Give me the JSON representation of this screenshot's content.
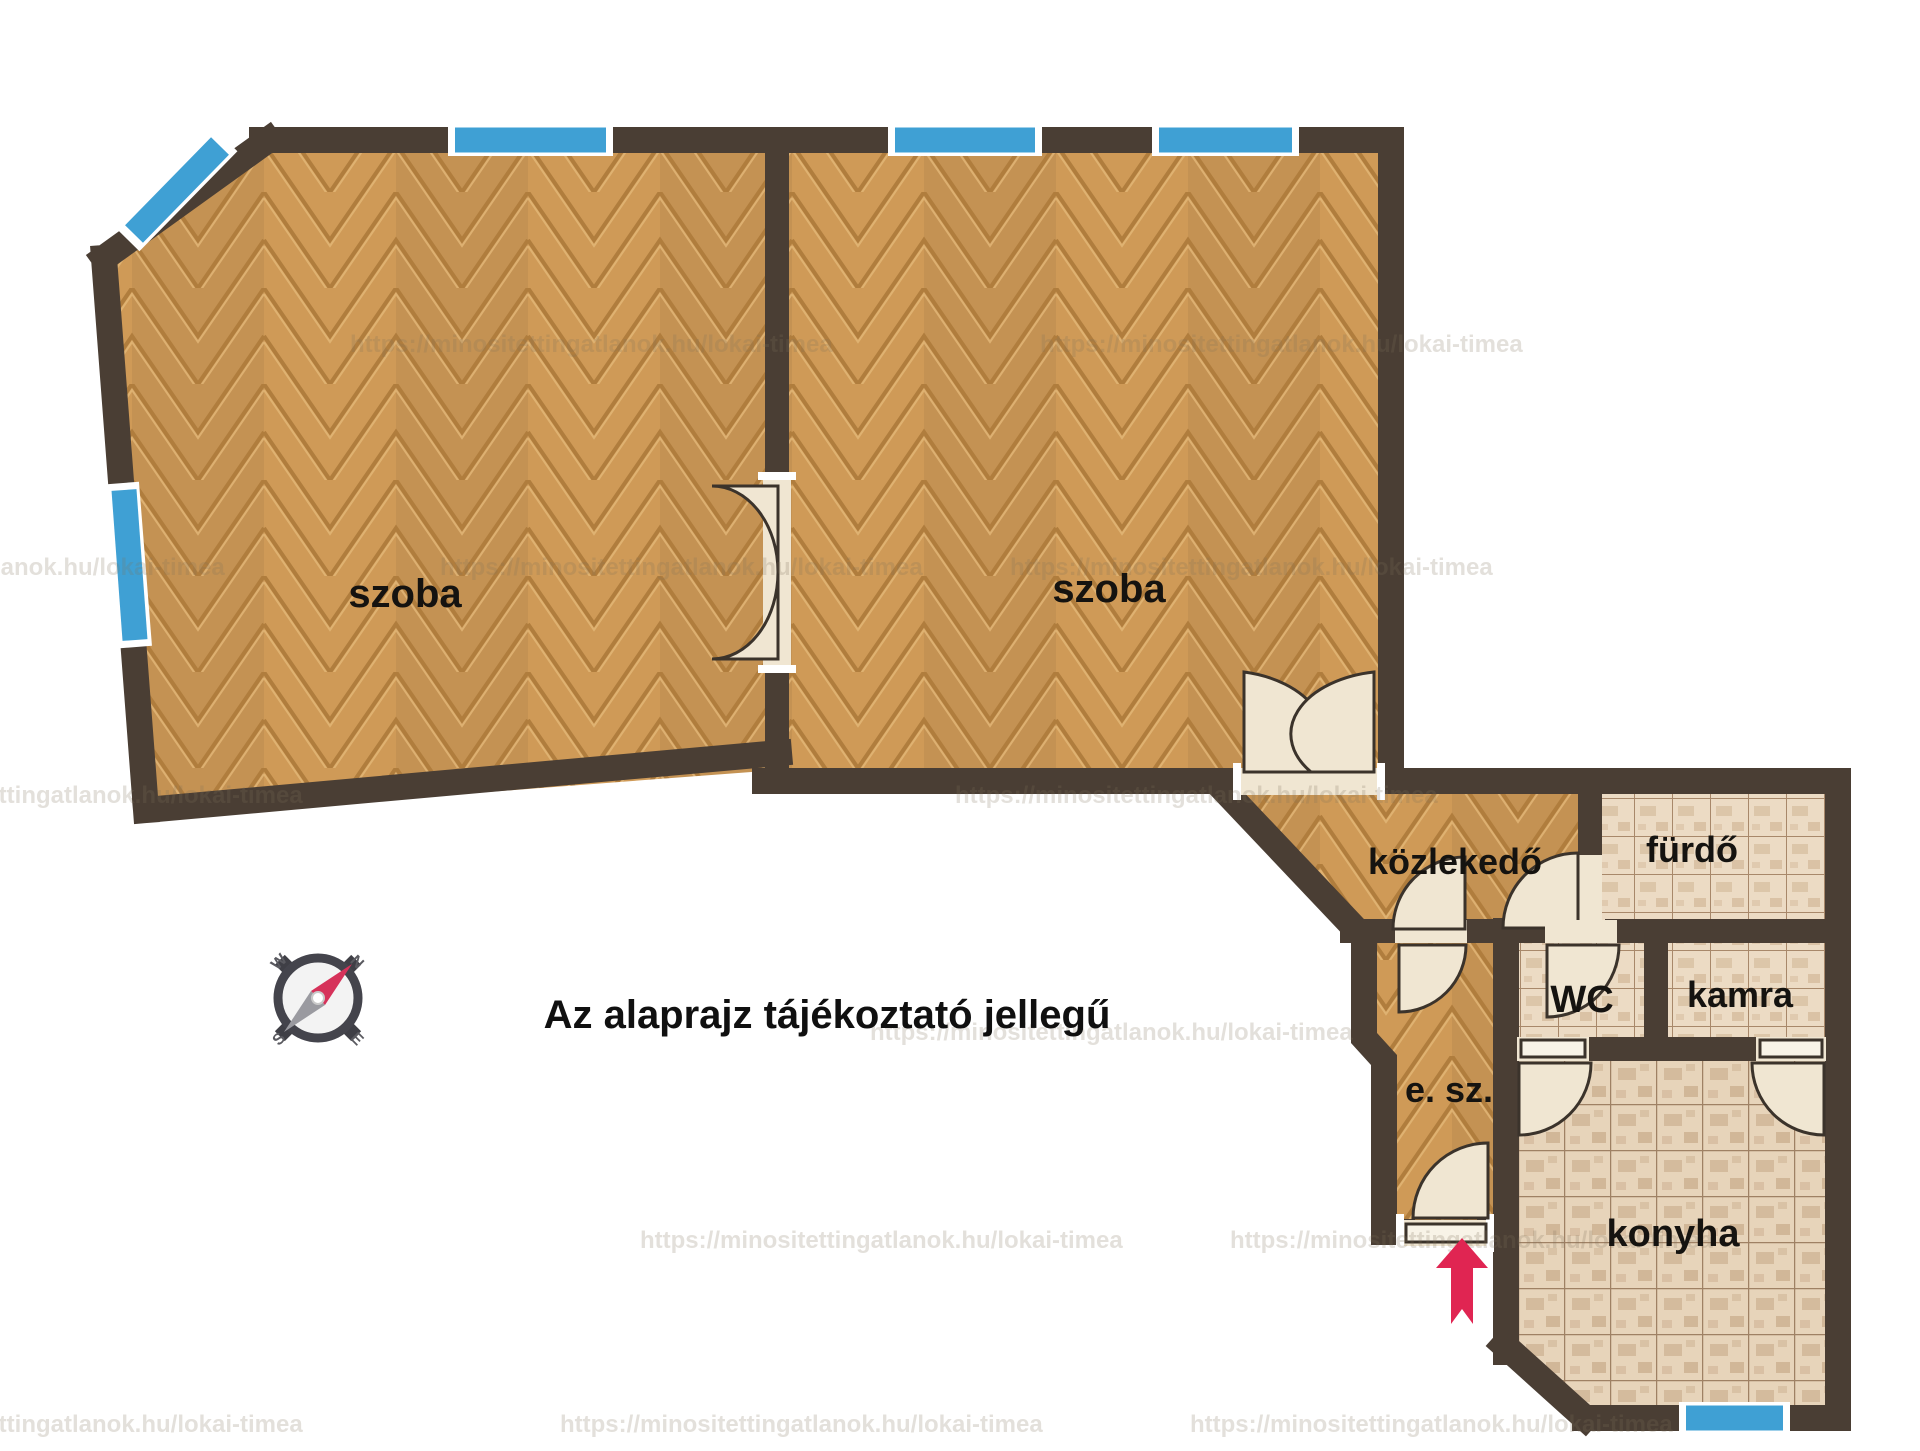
{
  "floorplan": {
    "rooms": {
      "szoba1": "szoba",
      "szoba2": "szoba",
      "kozlekedo": "közlekedő",
      "furdo": "fürdő",
      "wc": "WC",
      "kamra": "kamra",
      "esz": "e. sz.",
      "konyha": "konyha"
    },
    "disclaimer": "Az alaprajz tájékoztató jellegű",
    "watermark": "https://minositettingatlanok.hu/lokai-timea",
    "compass": {
      "n": "N",
      "w": "W",
      "s": "S",
      "e": "E"
    },
    "icons": {
      "compass": "compass-rose-icon",
      "entrance_arrow": "entrance-arrow-icon"
    },
    "colors": {
      "wall": "#4a3e34",
      "wood": "#cf9a57",
      "wood_seam": "#b07d3d",
      "tile": "#ecdbc4",
      "tile_grid": "#a8886a",
      "window": "#3fa0d4",
      "door": "#f0e6d2",
      "arrow": "#e02552"
    }
  }
}
